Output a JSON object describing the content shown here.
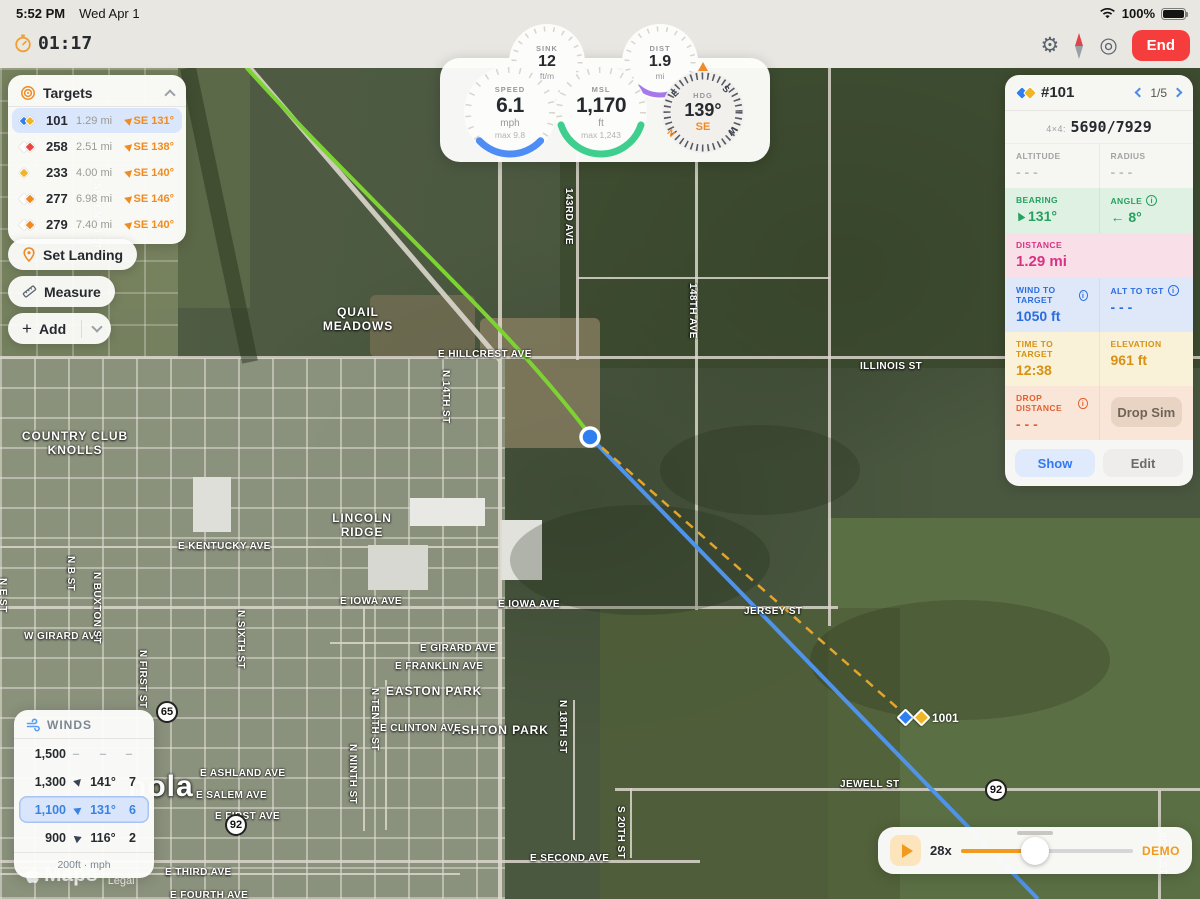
{
  "status_bar": {
    "time": "5:52 PM",
    "date": "Wed Apr 1",
    "battery": "100%"
  },
  "toolbar": {
    "timer": "01:17",
    "end": "End"
  },
  "icons": {
    "info": "i",
    "settings": "⚙",
    "locate": "◎"
  },
  "targets_panel": {
    "title": "Targets",
    "rows": [
      {
        "id": "101",
        "distance": "1.29 mi",
        "bearing": "SE 131°"
      },
      {
        "id": "258",
        "distance": "2.51 mi",
        "bearing": "SE 138°"
      },
      {
        "id": "233",
        "distance": "4.00 mi",
        "bearing": "SE 140°"
      },
      {
        "id": "277",
        "distance": "6.98 mi",
        "bearing": "SE 146°"
      },
      {
        "id": "279",
        "distance": "7.40 mi",
        "bearing": "SE 140°"
      }
    ]
  },
  "actions": {
    "set_landing": "Set Landing",
    "measure": "Measure",
    "add": "Add"
  },
  "gauges": {
    "sink": {
      "label": "SINK",
      "value": "12",
      "unit": "ft/m"
    },
    "dist": {
      "label": "DIST",
      "value": "1.9",
      "unit": "mi"
    },
    "speed": {
      "label": "SPEED",
      "value": "6.1",
      "unit": "mph",
      "max": "max 9.8"
    },
    "msl": {
      "label": "MSL",
      "value": "1,170",
      "unit": "ft",
      "max": "max 1,243"
    },
    "hdg": {
      "label": "HDG",
      "value": "139°",
      "cardinal": "SE",
      "compass": {
        "n": "N",
        "e": "E",
        "s": "S",
        "w": "W"
      }
    }
  },
  "target_detail": {
    "id": "#101",
    "pager": "1/5",
    "grid": {
      "label": "4×4:",
      "value": "5690/7929"
    },
    "altitude": {
      "label": "ALTITUDE",
      "value": "- - -"
    },
    "radius": {
      "label": "RADIUS",
      "value": "- - -"
    },
    "bearing": {
      "label": "BEARING",
      "value": "131°"
    },
    "angle": {
      "label": "ANGLE",
      "value": "← 8°"
    },
    "distance": {
      "label": "DISTANCE",
      "value": "1.29 mi"
    },
    "wind_to_target": {
      "label": "WIND TO TARGET",
      "value": "1050 ft"
    },
    "alt_to_tgt": {
      "label": "ALT TO TGT",
      "value": "- - -"
    },
    "time_to_target": {
      "label": "TIME TO TARGET",
      "value": "12:38"
    },
    "elevation": {
      "label": "ELEVATION",
      "value": "961 ft"
    },
    "drop_distance": {
      "label": "DROP DISTANCE",
      "value": "- - -"
    },
    "buttons": {
      "drop_sim": "Drop Sim",
      "show": "Show",
      "edit": "Edit"
    }
  },
  "winds_panel": {
    "title": "WINDS",
    "rows": [
      {
        "altitude": "1,500",
        "dash": "–",
        "direction": "–",
        "speed": "–"
      },
      {
        "altitude": "1,300",
        "direction": "141°",
        "speed": "7"
      },
      {
        "altitude": "1,100",
        "direction": "131°",
        "speed": "6"
      },
      {
        "altitude": "900",
        "direction": "116°",
        "speed": "2"
      }
    ],
    "footer": "200ft · mph"
  },
  "playback": {
    "speed": "28x",
    "mode": "DEMO"
  },
  "map": {
    "marker_label": "1001",
    "city_label": "nola",
    "attribution": {
      "brand": "Maps",
      "legal": "Legal"
    },
    "shields": [
      "65",
      "92",
      "92"
    ],
    "labels": [
      {
        "text": "QUAIL MEADOWS"
      },
      {
        "text": "LINCOLN RIDGE"
      },
      {
        "text": "COUNTRY CLUB KNOLLS"
      },
      {
        "text": "EASTON PARK"
      },
      {
        "text": "ASHTON PARK"
      },
      {
        "text": "E HILLCREST AVE"
      },
      {
        "text": "ILLINOIS ST"
      },
      {
        "text": "E KENTUCKY AVE"
      },
      {
        "text": "E IOWA AVE"
      },
      {
        "text": "E IOWA AVE"
      },
      {
        "text": "JERSEY ST"
      },
      {
        "text": "W GIRARD AVE"
      },
      {
        "text": "E GIRARD AVE"
      },
      {
        "text": "E FRANKLIN AVE"
      },
      {
        "text": "E CLINTON AVE"
      },
      {
        "text": "E ASHLAND AVE"
      },
      {
        "text": "E SALEM AVE"
      },
      {
        "text": "E FIRST AVE"
      },
      {
        "text": "E SECOND AVE"
      },
      {
        "text": "E THIRD AVE"
      },
      {
        "text": "E FOURTH AVE"
      },
      {
        "text": "JEWELL ST"
      },
      {
        "text": "143RD AVE"
      },
      {
        "text": "148TH AVE"
      },
      {
        "text": "N SEVENTH ST"
      },
      {
        "text": "N 14TH ST"
      },
      {
        "text": "N B ST"
      },
      {
        "text": "N BUXTON ST"
      },
      {
        "text": "N E ST"
      },
      {
        "text": "N FIRST ST"
      },
      {
        "text": "N SIXTH ST"
      },
      {
        "text": "N TENTH ST"
      },
      {
        "text": "N NINTH ST"
      },
      {
        "text": "N 18TH ST"
      },
      {
        "text": "S 20TH ST"
      },
      {
        "text": "80TH ST"
      }
    ]
  }
}
